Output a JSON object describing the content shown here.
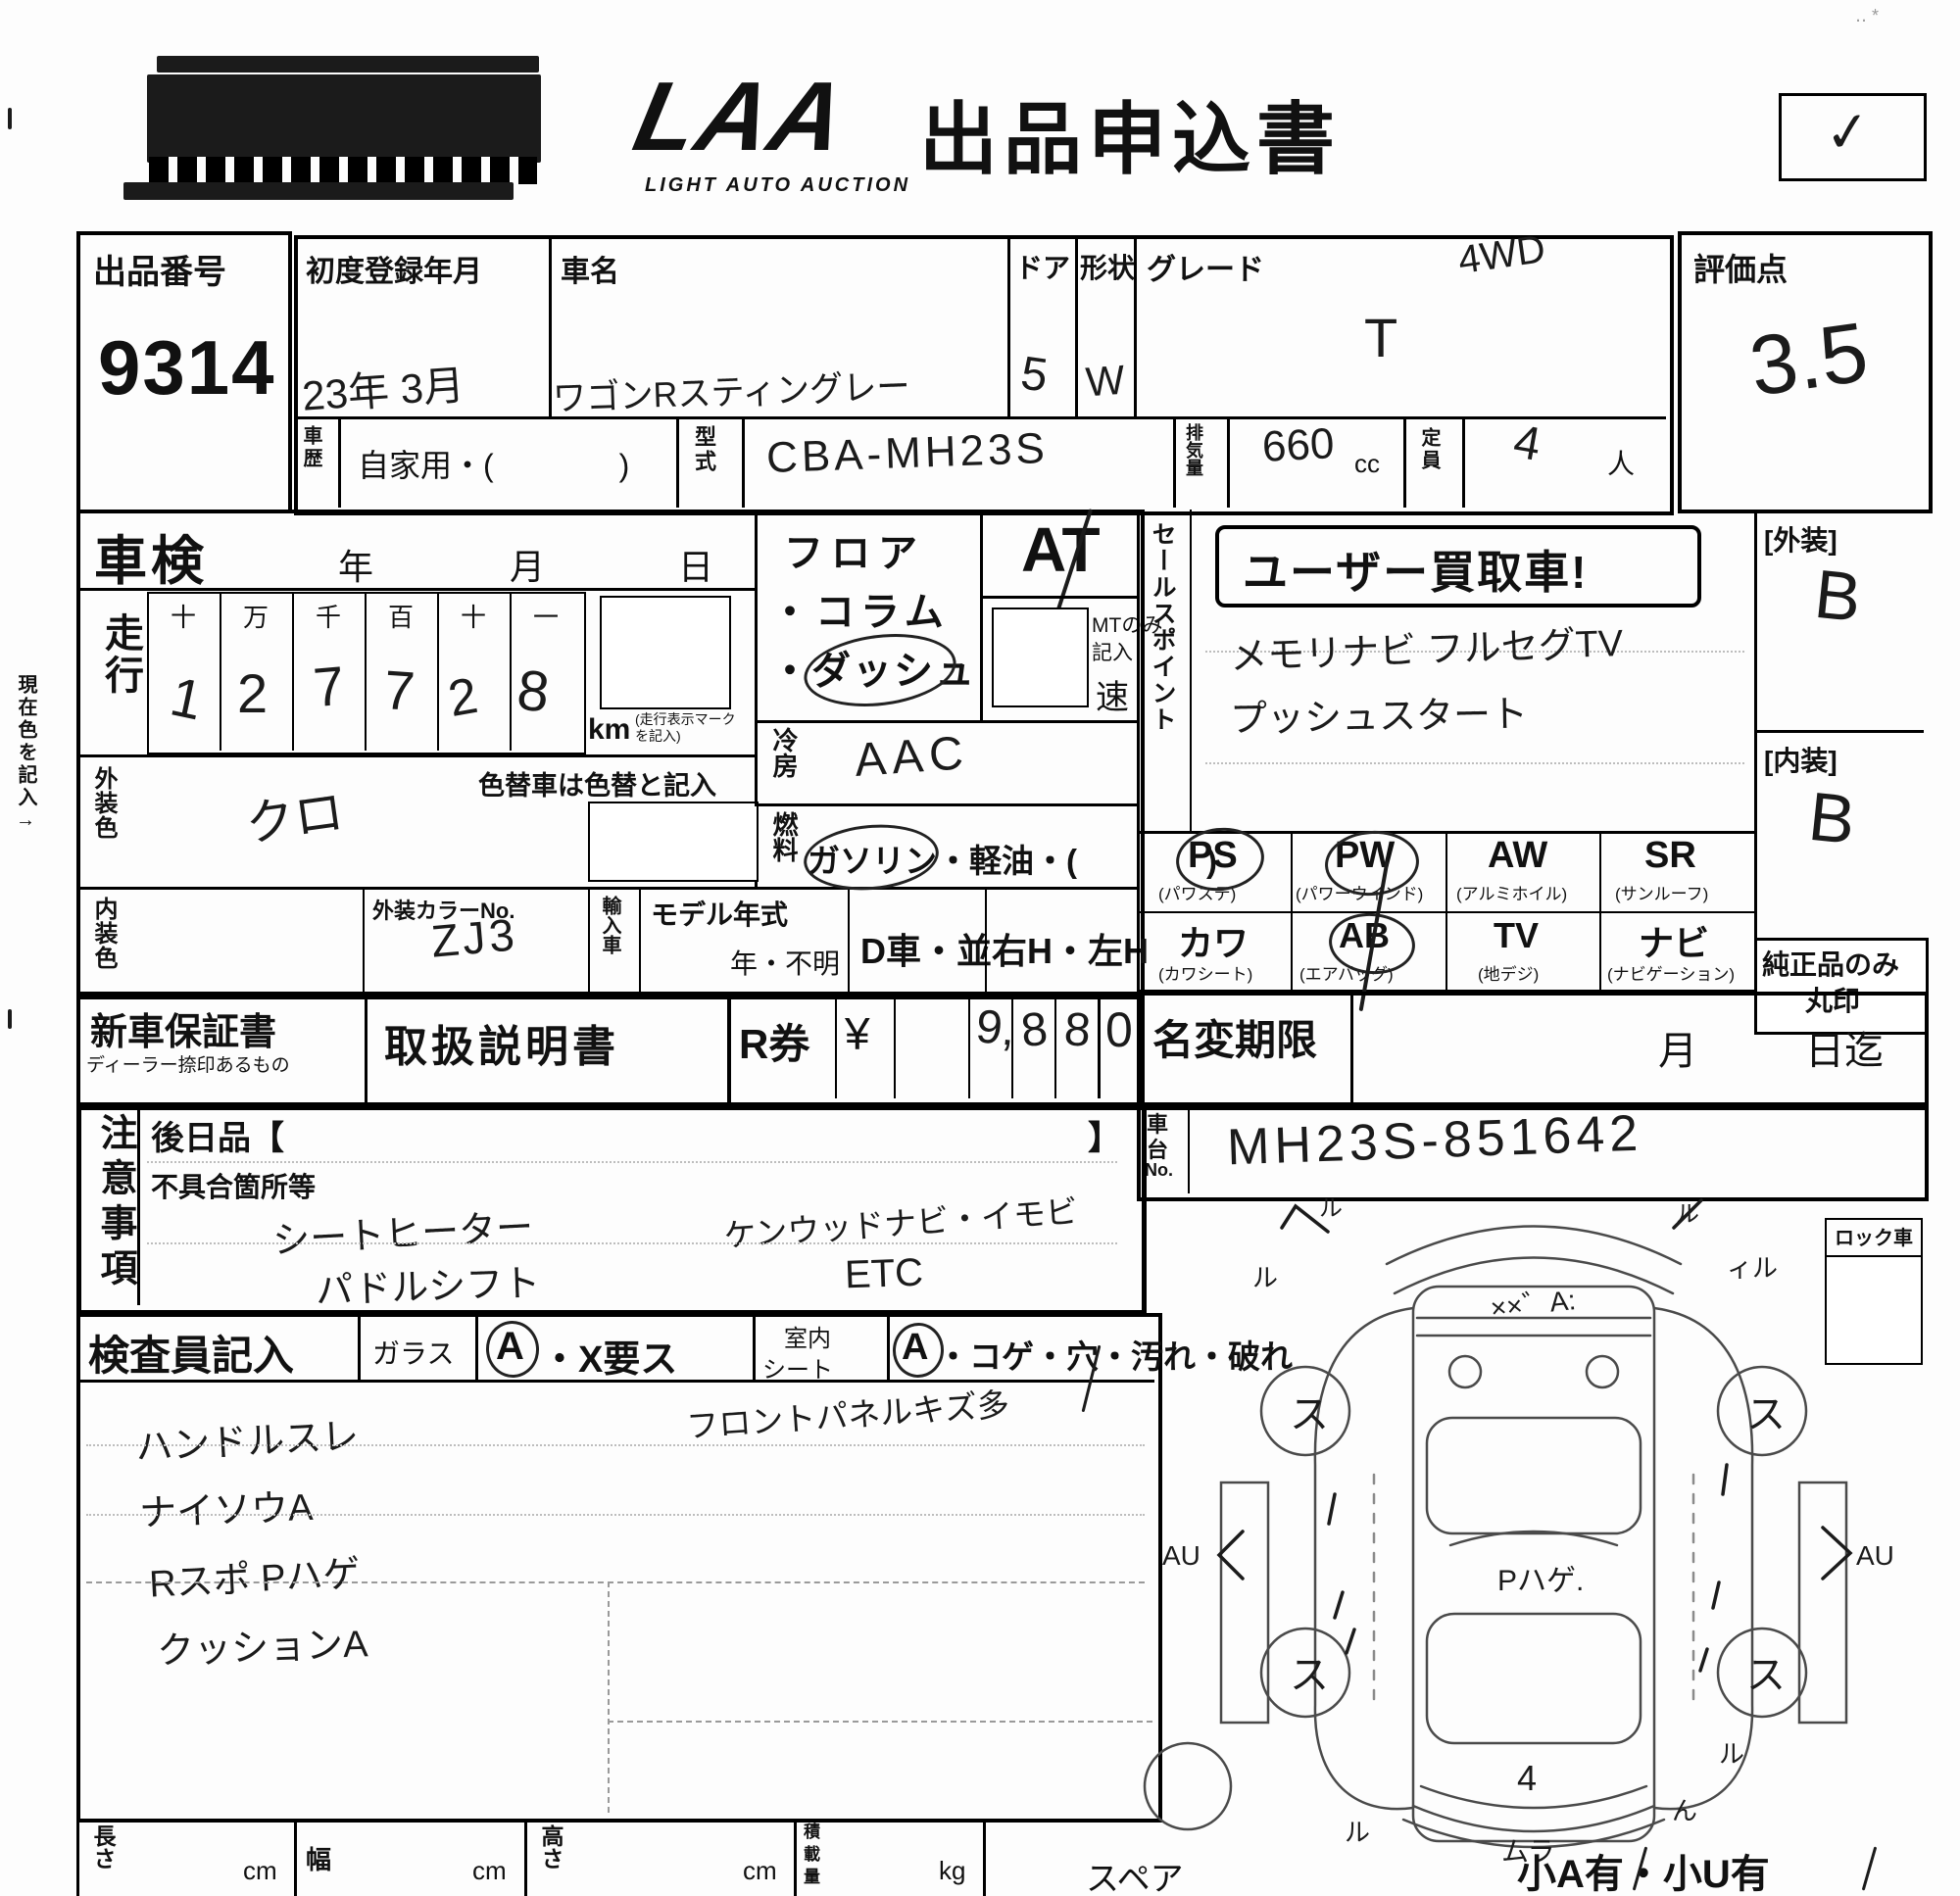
{
  "header": {
    "logo": "LAA",
    "logo_sub": "LIGHT AUTO AUCTION",
    "title": "出品申込書",
    "check": "✓",
    "scan_mark": "‥ *"
  },
  "margin_note": "現在色を記入→",
  "lot": {
    "label": "出品番号",
    "number": "9314"
  },
  "score": {
    "label": "評価点",
    "value": "3.5"
  },
  "reg": {
    "label": "初度登録年月",
    "value": "23年 3月"
  },
  "car_name": {
    "label": "車名",
    "value": "ワゴンRスティングレー"
  },
  "door": {
    "label": "ドア",
    "value": "5"
  },
  "shape": {
    "label": "形状",
    "value": "W"
  },
  "grade": {
    "label": "グレード",
    "value": "T",
    "note": "4WD"
  },
  "history": {
    "label1": "車",
    "label2": "歴",
    "value": "自家用・(　　　　)"
  },
  "model_code": {
    "label": "型式",
    "value": "CBA-MH23S"
  },
  "displacement": {
    "label": "排気量",
    "value": "660",
    "unit": "cc"
  },
  "capacity": {
    "label": "定員",
    "value": "4",
    "unit": "人"
  },
  "shaken": {
    "label": "車検",
    "year": "年",
    "month": "月",
    "day": "日"
  },
  "odometer": {
    "label": "走行",
    "headers": [
      "十",
      "万",
      "千",
      "百",
      "十",
      "一"
    ],
    "digits": [
      "1",
      "2",
      "7",
      "7",
      "2",
      "8"
    ],
    "unit": "km",
    "unit_note": "(走行表示マーク を記入)"
  },
  "ext_color": {
    "label": "外装色",
    "value": "クロ",
    "recolor_note": "色替車は色替と記入"
  },
  "int_color": {
    "label": "内装色",
    "color_no_label": "外装カラーNo.",
    "color_no": "ZJ3"
  },
  "import_car": {
    "label": "輸入車"
  },
  "model_year": {
    "label": "モデル年式",
    "unknown": "年・不明"
  },
  "d_car": "D車・並",
  "handle": "右H・左H",
  "mission": {
    "line1": "フロア",
    "line2": "・コラム",
    "line3": "・ダッシュ",
    "at": "AT",
    "mt1": "MTのみ",
    "mt2": "記入",
    "speed": "速"
  },
  "cooling": {
    "label": "冷房",
    "value": "AAC"
  },
  "fuel": {
    "label": "燃料",
    "options": "ガソリン・軽油・(　　　　)"
  },
  "sales": {
    "label": "セールスポイント",
    "stamp": "ユーザー買取車!",
    "line1": "メモリナビ フルセグTV",
    "line2": "プッシュスタート"
  },
  "exterior": {
    "label": "[外装]",
    "value": "B"
  },
  "interior": {
    "label": "[内装]",
    "value": "B"
  },
  "genuine": {
    "line1": "純正品のみ",
    "line2": "丸印"
  },
  "equipment": {
    "r1": [
      {
        "code": "PS",
        "name": "(パワステ)"
      },
      {
        "code": "PW",
        "name": "(パワーウインド)"
      },
      {
        "code": "AW",
        "name": "(アルミホイル)"
      },
      {
        "code": "SR",
        "name": "(サンルーフ)"
      }
    ],
    "r2": [
      {
        "code": "カワ",
        "name": "(カワシート)"
      },
      {
        "code": "AB",
        "name": "(エアバッグ)"
      },
      {
        "code": "TV",
        "name": "(地デジ)"
      },
      {
        "code": "ナビ",
        "name": "(ナビゲーション)"
      }
    ]
  },
  "warranty": {
    "label": "新車保証書",
    "sub": "ディーラー捺印あるもの"
  },
  "manual": {
    "label": "取扱説明書"
  },
  "r_ticket": {
    "label": "R券",
    "yen": "¥",
    "d1": "9,",
    "d2": "8",
    "d3": "8",
    "d4": "0"
  },
  "name_change": {
    "label": "名変期限",
    "month": "月",
    "until": "日迄"
  },
  "chassis": {
    "label1": "車",
    "label2": "台",
    "label3": "No.",
    "value": "MH23S-851642"
  },
  "lock": {
    "label": "ロック車"
  },
  "notes": {
    "label": "注意事項",
    "later": "後日品【",
    "later_close": "】",
    "defects": "不具合箇所等",
    "hw1": "シートヒーター",
    "hw2": "パドルシフト",
    "hw3": "ケンウッドナビ・イモビ",
    "hw4": "ETC"
  },
  "inspector": {
    "label": "検査員記入",
    "glass": "ガラス",
    "opt_a1": "A",
    "glass_opts": "・X要ス",
    "seat1": "室内",
    "seat2": "シート",
    "opt_a2": "A",
    "seat_opts": "・コゲ・穴・汚れ・破れ",
    "hw1": "ハンドルスレ",
    "hw2": "ナイソウA",
    "hw3": "Rスポ Pハゲ",
    "hw4": "クッションA",
    "hw_right": "フロントパネルキズ多"
  },
  "diagram": {
    "wheel_mark": "ス",
    "hood": "××゛A:",
    "center": "Pハゲ.",
    "tailgate": "4",
    "bumper_bottom": "ムラ",
    "left_arrow": "AU",
    "right_arrow": "AU",
    "corner_tl": "ル",
    "corner_tr": "ル",
    "fender_l": "ル",
    "fender_r": "ィル",
    "rear_l": "ル",
    "rear_r": "ん",
    "fender_rr": "ル",
    "spare": "スペア",
    "note": "小A有・小U有"
  },
  "dims": {
    "length": "長さ",
    "width": "幅",
    "height": "高さ",
    "load1": "積",
    "load2": "載",
    "load3": "量",
    "cm": "cm",
    "kg": "kg"
  }
}
